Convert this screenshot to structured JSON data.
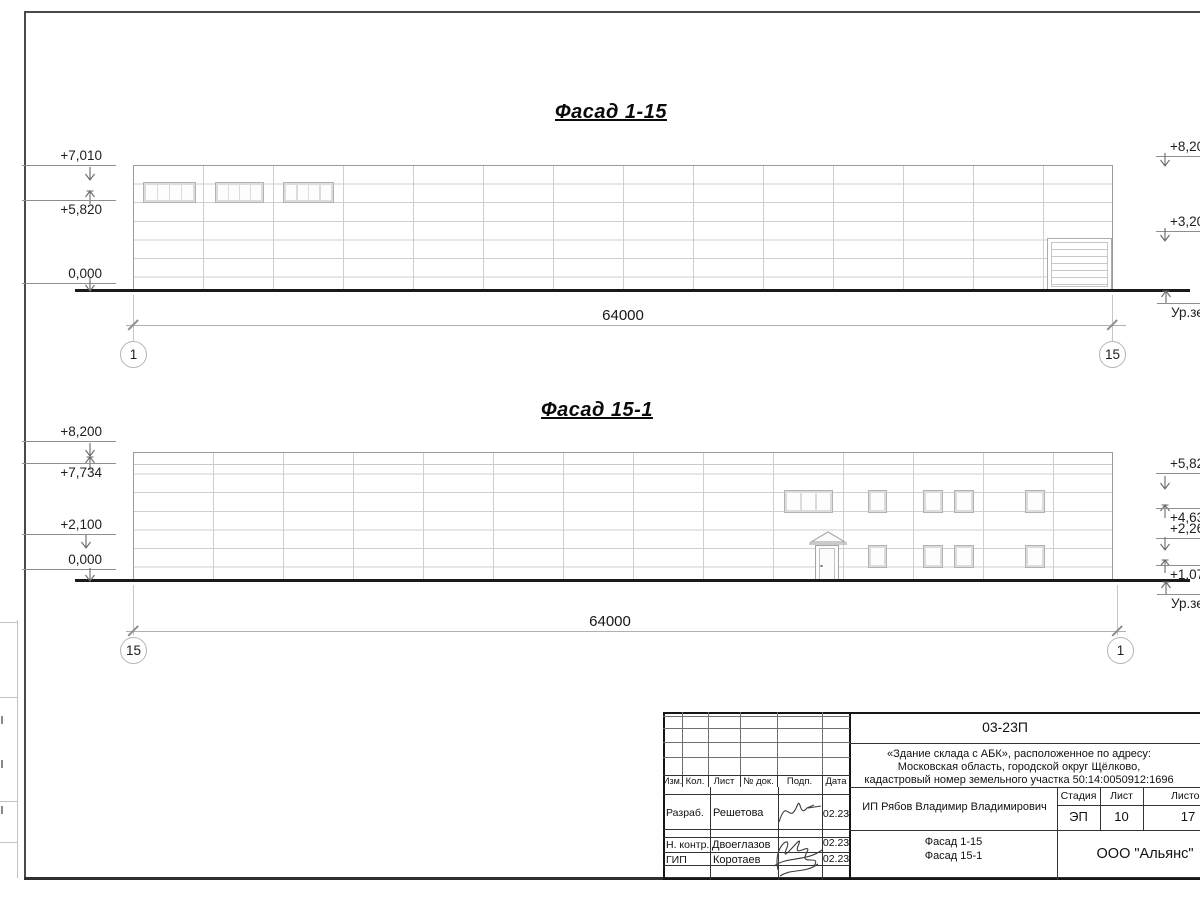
{
  "colors": {
    "panel_line": "#cfcfcf",
    "outline": "#9b9b9b",
    "ground_line": "#1a1a1a",
    "frame": "#4a4a4a",
    "text": "#1a1a1a"
  },
  "facade1": {
    "title": "Фасад 1-15",
    "dimension": "64000",
    "axis_left": "1",
    "axis_right": "15",
    "marks_left": [
      "+7,010",
      "+5,820",
      "0,000"
    ],
    "marks_right": [
      "+8,200",
      "+3,200"
    ],
    "ground_label": "Ур.земли"
  },
  "facade2": {
    "title": "Фасад 15-1",
    "dimension": "64000",
    "axis_left": "15",
    "axis_right": "1",
    "marks_left": [
      "+8,200",
      "+7,734",
      "+2,100",
      "0,000"
    ],
    "marks_right": [
      "+5,820",
      "+4,630",
      "+2,260",
      "+1,070"
    ],
    "ground_label": "Ур.земли"
  },
  "titleblock": {
    "doc_code": "03-23П",
    "project_line1": "«Здание склада с АБК», расположенное по адресу:",
    "project_line2": "Московская область, городской округ Щёлково,",
    "project_line3": "кадастровый номер земельного участка 50:14:0050912:1696",
    "col_izm": "Изм.",
    "col_kol": "Кол.",
    "col_list": "Лист",
    "col_doc": "№ док.",
    "col_podp": "Подп.",
    "col_data": "Дата",
    "client": "ИП Рябов Владимир Владимирович",
    "stage_label": "Стадия",
    "sheet_label": "Лист",
    "sheets_label": "Листов",
    "stage": "ЭП",
    "sheet": "10",
    "sheets": "17",
    "sheet_title1": "Фасад 1-15",
    "sheet_title2": "Фасад 15-1",
    "company": "ООО \"Альянс\"",
    "row1_role": "Разраб.",
    "row1_name": "Решетова",
    "row1_date": "02.23",
    "row2_role": "Н. контр.",
    "row2_name": "Двоеглазов",
    "row2_date": "02.23",
    "row3_role": "ГИП",
    "row3_name": "Коротаев",
    "row3_date": "02.23"
  }
}
